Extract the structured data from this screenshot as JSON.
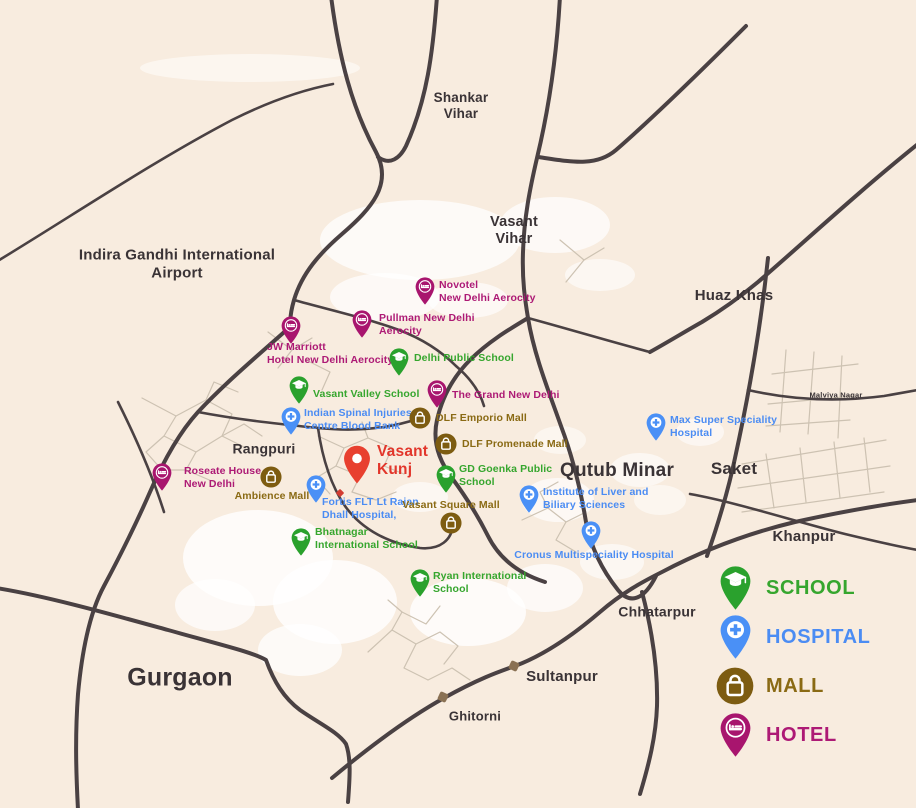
{
  "colors": {
    "background": "#f8ecdf",
    "road": "#4a4143",
    "area_text": "#3a3336",
    "school": "#2aa12d",
    "hospital": "#4a90f6",
    "mall": "#7d5c11",
    "hotel": "#a8156e",
    "highlight": "#e8402f",
    "school_text": "#36a62e",
    "hospital_text": "#4b8cf3",
    "mall_text": "#8a6a14",
    "hotel_text": "#ad1a75",
    "highlight_text": "#e2362b"
  },
  "legend": {
    "items": [
      {
        "type": "school",
        "label": "SCHOOL"
      },
      {
        "type": "hospital",
        "label": "HOSPITAL"
      },
      {
        "type": "mall",
        "label": "MALL"
      },
      {
        "type": "hotel",
        "label": "HOTEL"
      }
    ]
  },
  "areas": [
    {
      "name": "Shankar\nVihar",
      "x": 461,
      "y": 106,
      "size": 13.5,
      "weight": 700
    },
    {
      "name": "Vasant\nVihar",
      "x": 514,
      "y": 231,
      "size": 14.5,
      "weight": 700
    },
    {
      "name": "Indira Gandhi International\nAirport",
      "x": 177,
      "y": 264,
      "size": 15,
      "weight": 700
    },
    {
      "name": "Huaz Khas",
      "x": 734,
      "y": 296,
      "size": 15,
      "weight": 700
    },
    {
      "name": "Malviya Nagar",
      "x": 836,
      "y": 396,
      "size": 7.5,
      "weight": 600
    },
    {
      "name": "Rangpuri",
      "x": 264,
      "y": 449,
      "size": 14,
      "weight": 700
    },
    {
      "name": "Qutub Minar",
      "x": 617,
      "y": 471,
      "size": 19,
      "weight": 700
    },
    {
      "name": "Saket",
      "x": 734,
      "y": 469,
      "size": 17,
      "weight": 700
    },
    {
      "name": "Khanpur",
      "x": 804,
      "y": 537,
      "size": 15,
      "weight": 600
    },
    {
      "name": "Chhatarpur",
      "x": 657,
      "y": 612,
      "size": 14,
      "weight": 600
    },
    {
      "name": "Sultanpur",
      "x": 562,
      "y": 677,
      "size": 15,
      "weight": 700
    },
    {
      "name": "Ghitorni",
      "x": 475,
      "y": 716,
      "size": 13,
      "weight": 600
    },
    {
      "name": "Gurgaon",
      "x": 180,
      "y": 678,
      "size": 25,
      "weight": 600
    }
  ],
  "pois": [
    {
      "type": "hotel",
      "label": "Novotel\nNew Delhi Aerocity",
      "pin": {
        "x": 425,
        "y": 287
      },
      "lab": {
        "x": 439,
        "y": 279,
        "align": "left"
      }
    },
    {
      "type": "hotel",
      "label": "Pullman New Delhi\nAerocity",
      "pin": {
        "x": 362,
        "y": 320
      },
      "lab": {
        "x": 379,
        "y": 312,
        "align": "left"
      }
    },
    {
      "type": "hotel",
      "label": "JW Marriott\nHotel New Delhi Aerocity",
      "pin": {
        "x": 291,
        "y": 326
      },
      "lab": {
        "x": 267,
        "y": 341,
        "align": "left"
      }
    },
    {
      "type": "hotel",
      "label": "The Grand New Delhi",
      "pin": {
        "x": 437,
        "y": 390
      },
      "lab": {
        "x": 452,
        "y": 389,
        "align": "left"
      }
    },
    {
      "type": "hotel",
      "label": "Roseate House\nNew Delhi",
      "pin": {
        "x": 162,
        "y": 473
      },
      "lab": {
        "x": 184,
        "y": 465,
        "align": "left"
      }
    },
    {
      "type": "school",
      "label": "Delhi Public School",
      "pin": {
        "x": 399,
        "y": 358
      },
      "lab": {
        "x": 414,
        "y": 352,
        "align": "left"
      }
    },
    {
      "type": "school",
      "label": "Vasant Valley School",
      "pin": {
        "x": 299,
        "y": 386
      },
      "lab": {
        "x": 313,
        "y": 388,
        "align": "left"
      }
    },
    {
      "type": "school",
      "label": "GD Goenka Public\nSchool",
      "pin": {
        "x": 446,
        "y": 475
      },
      "lab": {
        "x": 459,
        "y": 463,
        "align": "left"
      }
    },
    {
      "type": "school",
      "label": "Bhatnagar\nInternational School",
      "pin": {
        "x": 301,
        "y": 538
      },
      "lab": {
        "x": 315,
        "y": 526,
        "align": "left"
      }
    },
    {
      "type": "school",
      "label": "Ryan International\nSchool",
      "pin": {
        "x": 420,
        "y": 579
      },
      "lab": {
        "x": 433,
        "y": 570,
        "align": "left"
      }
    },
    {
      "type": "hospital",
      "label": "Indian Spinal Injuries\nCentre Blood Bank",
      "pin": {
        "x": 291,
        "y": 417
      },
      "lab": {
        "x": 304,
        "y": 407,
        "align": "left"
      }
    },
    {
      "type": "hospital",
      "label": "Fortis FLT Lt Rajan\nDhall Hospital,",
      "pin": {
        "x": 316,
        "y": 485
      },
      "lab": {
        "x": 322,
        "y": 496,
        "align": "left"
      }
    },
    {
      "type": "hospital",
      "label": "Max Super Speciality\nHospital",
      "pin": {
        "x": 656,
        "y": 423
      },
      "lab": {
        "x": 670,
        "y": 414,
        "align": "left"
      }
    },
    {
      "type": "hospital",
      "label": "Institute of Liver and\nBiliary Sciences",
      "pin": {
        "x": 529,
        "y": 495
      },
      "lab": {
        "x": 543,
        "y": 486,
        "align": "left"
      }
    },
    {
      "type": "hospital",
      "label": "Cronus Multispeciality Hospital",
      "pin": {
        "x": 591,
        "y": 531
      },
      "lab": {
        "x": 594,
        "y": 549,
        "align": "center"
      }
    },
    {
      "type": "mall",
      "label": "DLF Emporio Mall",
      "pin": {
        "x": 420,
        "y": 418
      },
      "lab": {
        "x": 436,
        "y": 412,
        "align": "left"
      }
    },
    {
      "type": "mall",
      "label": "DLF Promenade Mall",
      "pin": {
        "x": 446,
        "y": 444
      },
      "lab": {
        "x": 462,
        "y": 438,
        "align": "left"
      }
    },
    {
      "type": "mall",
      "label": "Ambience Mall",
      "pin": {
        "x": 271,
        "y": 477
      },
      "lab": {
        "x": 272,
        "y": 490,
        "align": "center"
      }
    },
    {
      "type": "mall",
      "label": "Vasant Square Mall",
      "pin": {
        "x": 451,
        "y": 523
      },
      "lab": {
        "x": 451,
        "y": 499,
        "align": "center"
      }
    },
    {
      "type": "highlight",
      "label": "Vasant\nKunj",
      "pin": {
        "x": 357,
        "y": 459
      },
      "lab": {
        "x": 377,
        "y": 443,
        "align": "left"
      }
    }
  ]
}
